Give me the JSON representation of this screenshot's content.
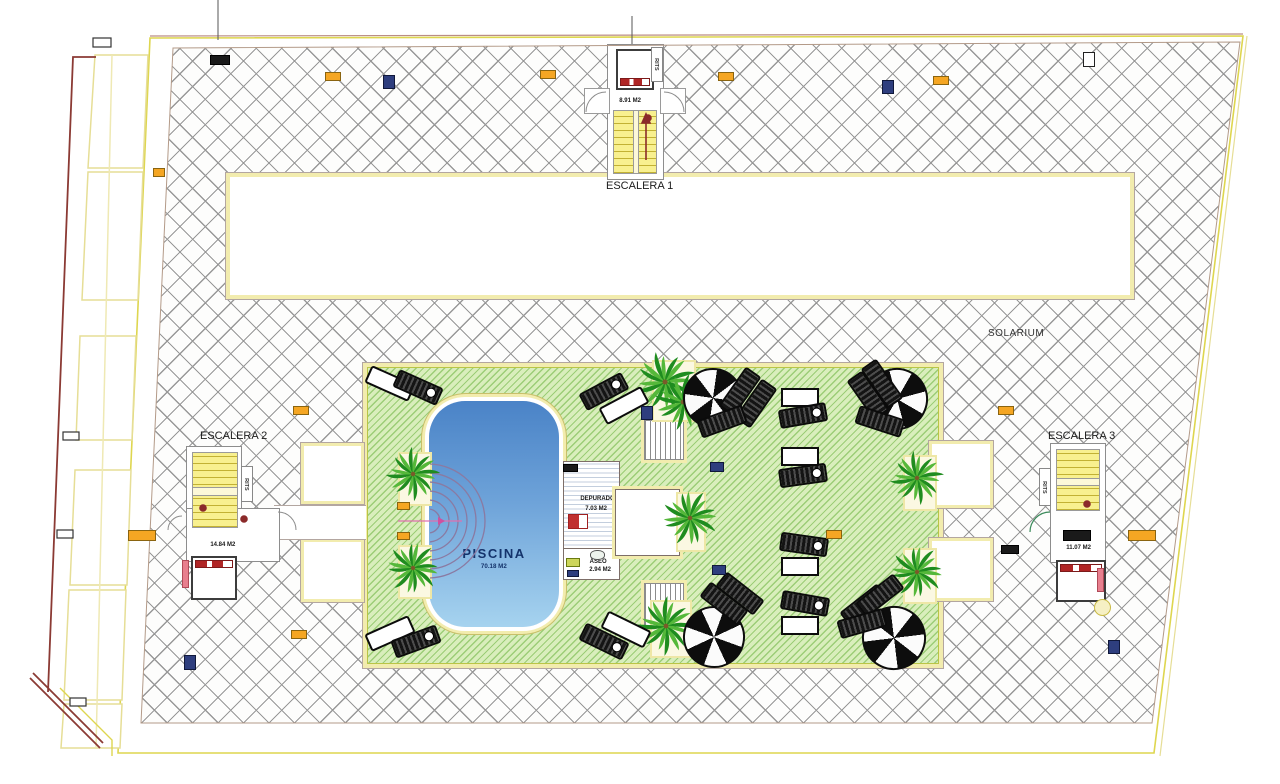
{
  "plan": {
    "solarium_label": "SOLARIUM",
    "escalera1": {
      "title": "ESCALERA 1",
      "area": "8.91 M2",
      "rits": "RITS"
    },
    "escalera2": {
      "title": "ESCALERA 2",
      "area": "14.84 M2",
      "rits": "RITS"
    },
    "escalera3": {
      "title": "ESCALERA 3",
      "area": "11.07 M2",
      "rits": "RITS"
    },
    "pool": {
      "title": "PISCINA",
      "area": "70.18 M2"
    },
    "depuradora": {
      "title": "DEPURADORA",
      "area": "7.03 M2"
    },
    "aseo": {
      "title": "ASEO",
      "area": "2.94 M2"
    }
  },
  "colors": {
    "hatch_line": "#989898",
    "boundary_yellow": "#ded64f",
    "terrace_green": "#d9eebc",
    "terrace_stripe": "#6ab23e",
    "pool_top": "#4a83c7",
    "pool_bottom": "#a6d3ef",
    "stair_yellow": "#f8f08f",
    "detail_red": "#8b2a2a",
    "badge_orange": "#f5a623",
    "badge_blue": "#2e3e7e"
  }
}
